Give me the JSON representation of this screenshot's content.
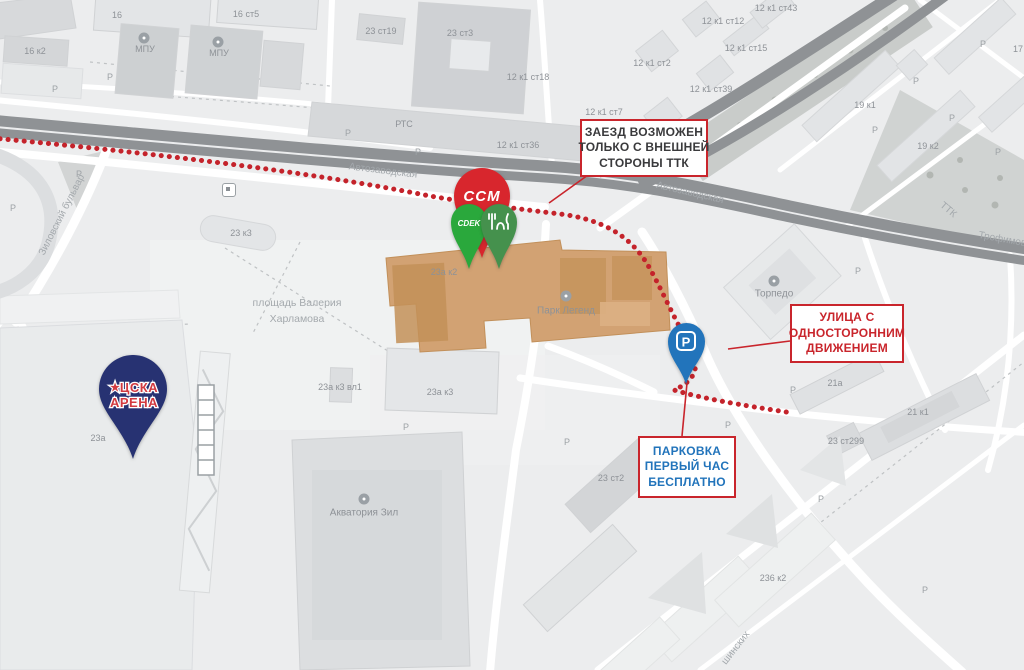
{
  "colors": {
    "route_red": "#c4232b",
    "callout_border": "#c9252c",
    "callout1_text": "#3a3a3c",
    "callout2_text": "#c9252c",
    "callout3_text": "#2274bb",
    "ccm_red": "#d8262d",
    "cdek_green": "#2aa83c",
    "food_green": "#45914d",
    "cska_navy": "#273272",
    "cska_text_red": "#d23a40",
    "parking_blue": "#2274bb",
    "highway_gray": "#8f9295",
    "poi_building_tan": "#d2a273"
  },
  "map": {
    "parking_glyph": "Р",
    "labels": [
      {
        "t": "16 к2",
        "x": 35,
        "y": 51
      },
      {
        "t": "16",
        "x": 117,
        "y": 15
      },
      {
        "t": "МПУ",
        "x": 145,
        "y": 49
      },
      {
        "t": "16 ст5",
        "x": 246,
        "y": 14
      },
      {
        "t": "МПУ",
        "x": 219,
        "y": 53
      },
      {
        "t": "23 ст19",
        "x": 381,
        "y": 31
      },
      {
        "t": "23 ст3",
        "x": 460,
        "y": 33
      },
      {
        "t": "РТС",
        "x": 404,
        "y": 124
      },
      {
        "t": "12 к1 ст18",
        "x": 528,
        "y": 77
      },
      {
        "t": "12 к1 ст36",
        "x": 518,
        "y": 145
      },
      {
        "t": "12 к1 ст2",
        "x": 652,
        "y": 63
      },
      {
        "t": "12 к1 ст12",
        "x": 723,
        "y": 21
      },
      {
        "t": "12 к1 ст43",
        "x": 776,
        "y": 8
      },
      {
        "t": "12 к1 ст15",
        "x": 746,
        "y": 48
      },
      {
        "t": "12 к1 ст39",
        "x": 711,
        "y": 89
      },
      {
        "t": "12 к1 ст7",
        "x": 604,
        "y": 112
      },
      {
        "t": "19 к1",
        "x": 865,
        "y": 105
      },
      {
        "t": "19 к2",
        "x": 928,
        "y": 146
      },
      {
        "t": "17",
        "x": 1018,
        "y": 49
      },
      {
        "t": "23 к3",
        "x": 241,
        "y": 233
      },
      {
        "t": "23а к2",
        "x": 444,
        "y": 272
      },
      {
        "t": "Парк Легенд",
        "x": 566,
        "y": 311,
        "s": 10
      },
      {
        "t": "23а к3 вл1",
        "x": 340,
        "y": 387
      },
      {
        "t": "23а к3",
        "x": 440,
        "y": 392
      },
      {
        "t": "23а",
        "x": 98,
        "y": 438
      },
      {
        "t": "Торпедо",
        "x": 774,
        "y": 294,
        "s": 10
      },
      {
        "t": "Акватория Зил",
        "x": 364,
        "y": 513,
        "s": 10
      },
      {
        "t": "23 ст2",
        "x": 611,
        "y": 478
      },
      {
        "t": "21а",
        "x": 835,
        "y": 383
      },
      {
        "t": "21 к1",
        "x": 918,
        "y": 412
      },
      {
        "t": "23 ст299",
        "x": 846,
        "y": 441
      },
      {
        "t": "236 к2",
        "x": 773,
        "y": 578
      },
      {
        "t": "площадь Валерия",
        "x": 297,
        "y": 303,
        "s": 10.5,
        "c": "street"
      },
      {
        "t": "Харламова",
        "x": 297,
        "y": 319,
        "s": 10.5,
        "c": "street"
      },
      {
        "t": "Автозаводская",
        "x": 383,
        "y": 171,
        "r": 7,
        "c": "street"
      },
      {
        "t": "Автозаводская",
        "x": 690,
        "y": 193,
        "r": 13,
        "c": "street"
      },
      {
        "t": "Зиловский бульвар",
        "x": 62,
        "y": 215,
        "r": -63,
        "c": "street"
      },
      {
        "t": "ТТК",
        "x": 948,
        "y": 210,
        "r": 40,
        "c": "street"
      },
      {
        "t": "Трофимова",
        "x": 1005,
        "y": 240,
        "r": 10,
        "c": "street"
      },
      {
        "t": "шинских",
        "x": 736,
        "y": 648,
        "r": -52,
        "c": "street"
      }
    ],
    "parking_markers": [
      [
        13,
        208
      ],
      [
        55,
        89
      ],
      [
        110,
        77
      ],
      [
        79,
        174
      ],
      [
        348,
        133
      ],
      [
        418,
        152
      ],
      [
        406,
        427
      ],
      [
        567,
        442
      ],
      [
        858,
        271
      ],
      [
        793,
        390
      ],
      [
        821,
        499
      ],
      [
        983,
        44
      ],
      [
        916,
        81
      ],
      [
        875,
        130
      ],
      [
        952,
        118
      ],
      [
        998,
        152
      ],
      [
        925,
        590
      ],
      [
        728,
        425
      ]
    ],
    "poi_icons": [
      {
        "x": 144,
        "y": 38
      },
      {
        "x": 218,
        "y": 42
      },
      {
        "x": 566,
        "y": 296
      },
      {
        "x": 774,
        "y": 281
      },
      {
        "x": 364,
        "y": 499
      }
    ],
    "bus_stop": {
      "x": 229,
      "y": 190
    }
  },
  "pins": {
    "ccm": {
      "label": "CCM"
    },
    "cdek": {
      "label": "CDEK"
    },
    "food": {
      "icon": "fork-and-knife"
    },
    "cska": {
      "star": "★",
      "line1": "ЦСКА",
      "line2": "АРЕНА"
    },
    "parking": {
      "glyph": "P"
    }
  },
  "callouts": [
    {
      "lines": [
        "ЗАЕЗД ВОЗМОЖЕН",
        "ТОЛЬКО С ВНЕШНЕЙ",
        "СТОРОНЫ ТТК"
      ]
    },
    {
      "lines": [
        "УЛИЦА С",
        "ОДНОСТОРОННИМ",
        "ДВИЖЕНИЕМ"
      ]
    },
    {
      "lines": [
        "ПАРКОВКА",
        "ПЕРВЫЙ ЧАС",
        "БЕСПЛАТНО"
      ]
    }
  ]
}
